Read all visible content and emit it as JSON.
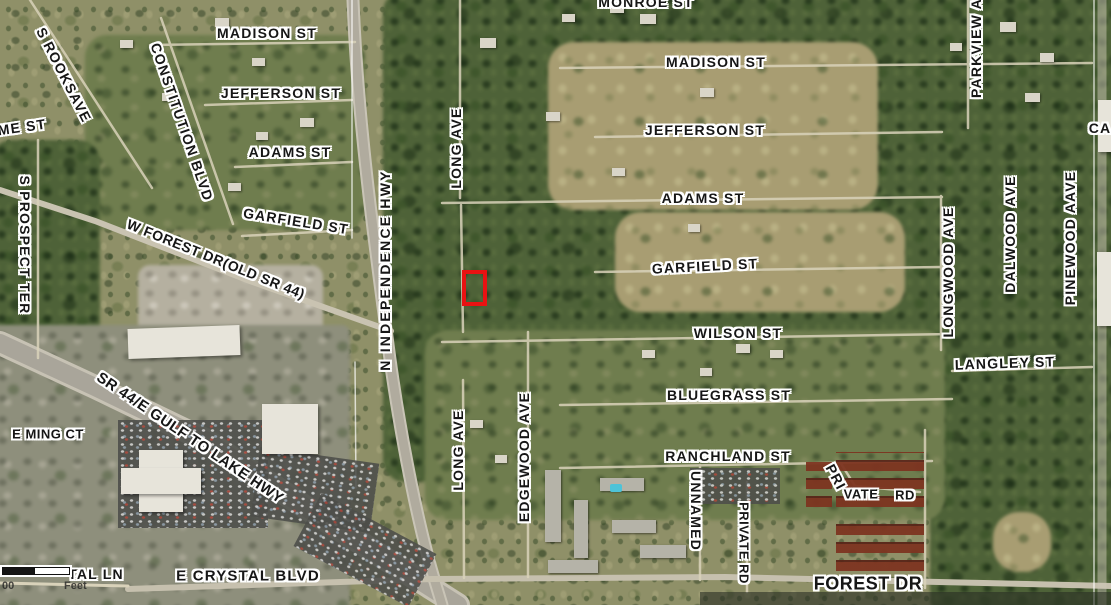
{
  "labels": [
    {
      "text": "MONROE ST",
      "x": 646,
      "y": 2
    },
    {
      "text": "MADISON ST",
      "x": 267,
      "y": 33
    },
    {
      "text": "JEFFERSON ST",
      "x": 281,
      "y": 93
    },
    {
      "text": "ADAMS ST",
      "x": 290,
      "y": 152
    },
    {
      "text": "GARFIELD ST",
      "x": 296,
      "y": 221,
      "rot": 9
    },
    {
      "text": "MADISON ST",
      "x": 716,
      "y": 62
    },
    {
      "text": "JEFFERSON ST",
      "x": 705,
      "y": 130
    },
    {
      "text": "ADAMS ST",
      "x": 703,
      "y": 198
    },
    {
      "text": "GARFIELD ST",
      "x": 705,
      "y": 266,
      "rot": -3
    },
    {
      "text": "WILSON ST",
      "x": 738,
      "y": 333
    },
    {
      "text": "BLUEGRASS ST",
      "x": 729,
      "y": 395
    },
    {
      "text": "RANCHLAND ST",
      "x": 728,
      "y": 456
    },
    {
      "text": "LANGLEY ST",
      "x": 1005,
      "y": 363,
      "rot": -2
    },
    {
      "text": "E CRYSTAL BLVD",
      "x": 248,
      "y": 576,
      "size": 15
    },
    {
      "text": "TAL LN",
      "x": 96,
      "y": 574
    },
    {
      "text": "FOREST DR",
      "x": 868,
      "y": 584,
      "size": 18,
      "ls": 0.5
    },
    {
      "text": "ME ST",
      "x": 22,
      "y": 127,
      "rot": -8
    },
    {
      "text": "E MING CT",
      "x": 48,
      "y": 434,
      "size": 13,
      "ls": 0.5
    },
    {
      "text": "S ROOKSAVE",
      "x": 64,
      "y": 75,
      "rot": 63
    },
    {
      "text": "CONSTITUTION BLVD",
      "x": 182,
      "y": 122,
      "rot": 71
    },
    {
      "text": "W FOREST DR(OLD SR 44)",
      "x": 216,
      "y": 259,
      "rot": 22,
      "ls": 0.5
    },
    {
      "text": "SR 44/E GULF TO LAKE HWY",
      "x": 190,
      "y": 438,
      "rot": 34,
      "size": 15,
      "ls": 0.5
    },
    {
      "text": "S PROSPECT TER",
      "x": 25,
      "y": 245,
      "rot": 90
    },
    {
      "text": "N INDEPENDENCE HWY",
      "x": 385,
      "y": 270,
      "rot": -90,
      "ls": 2.2
    },
    {
      "text": "LONG AVE",
      "x": 456,
      "y": 148,
      "rot": -90
    },
    {
      "text": "LONG AVE",
      "x": 458,
      "y": 450,
      "rot": -90
    },
    {
      "text": "EDGEWOOD AVE",
      "x": 524,
      "y": 457,
      "rot": -90
    },
    {
      "text": "UNNAMED",
      "x": 696,
      "y": 511,
      "rot": 90
    },
    {
      "text": "PRIVATE RD",
      "x": 744,
      "y": 543,
      "rot": 90,
      "size": 13,
      "ls": 0.5
    },
    {
      "text": "PRI",
      "x": 836,
      "y": 477,
      "rot": 62
    },
    {
      "text": "VATE",
      "x": 861,
      "y": 494,
      "size": 13,
      "ls": 0.5
    },
    {
      "text": "RD",
      "x": 905,
      "y": 495,
      "size": 13,
      "ls": 0.5
    },
    {
      "text": "LONGWOOD AVE",
      "x": 948,
      "y": 272,
      "rot": -90
    },
    {
      "text": "DALWOOD AVE",
      "x": 1010,
      "y": 234,
      "rot": -90
    },
    {
      "text": "PINEWOOD AAVE",
      "x": 1070,
      "y": 238,
      "rot": -90
    },
    {
      "text": "PARKVIEW AVE",
      "x": 976,
      "y": 38,
      "rot": -90
    },
    {
      "text": "CA",
      "x": 1100,
      "y": 128
    }
  ],
  "marker": {
    "x": 462,
    "y": 270,
    "w": 17,
    "h": 28,
    "color": "#ea1212"
  },
  "scale_bar": {
    "left_label": "00",
    "right_label": "Feet"
  },
  "colors": {
    "label_text": "#161616",
    "label_halo": "#ffffff",
    "marker_red": "#ea1212"
  }
}
